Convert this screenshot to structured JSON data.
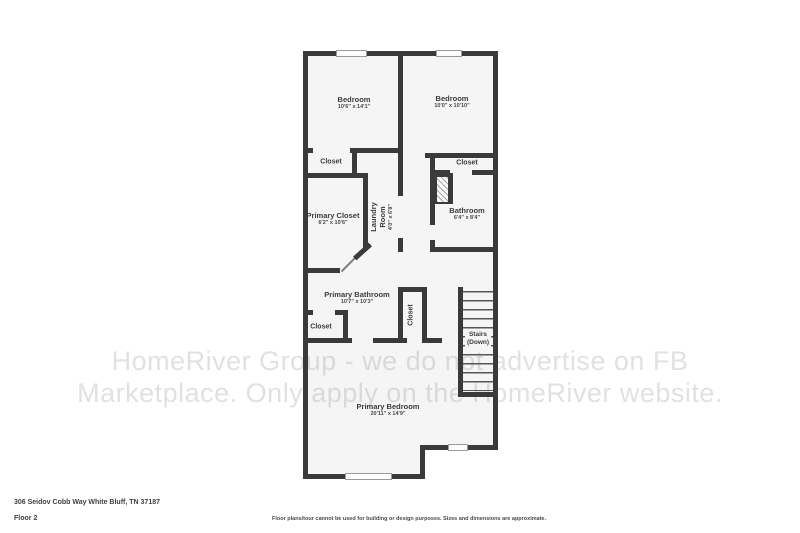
{
  "meta": {
    "address": "306 Seidov Cobb Way White Bluff, TN 37187",
    "floor_label": "Floor 2",
    "disclaimer": "Floor plans/tour cannot be used for building or design purposes. Sizes and dimensions are approximate."
  },
  "watermark": {
    "line1": "HomeRiver Group - we do not advertise on FB",
    "line2": "Marketplace. Only apply on the HomeRiver website."
  },
  "rooms": {
    "bedroom_left": {
      "name": "Bedroom",
      "dims": "10'6\" x 14'1\""
    },
    "bedroom_right": {
      "name": "Bedroom",
      "dims": "10'0\" x 10'10\""
    },
    "closet_left": {
      "name": "Closet"
    },
    "closet_right": {
      "name": "Closet"
    },
    "primary_closet": {
      "name": "Primary Closet",
      "dims": "6'2\" x 10'6\""
    },
    "laundry": {
      "name": "Laundry Room",
      "dims": "4'0\" x 6'8\""
    },
    "bathroom": {
      "name": "Bathroom",
      "dims": "6'4\" x 8'4\""
    },
    "primary_bathroom": {
      "name": "Primary Bathroom",
      "dims": "10'7\" x 10'3\""
    },
    "hall_closet": {
      "name": "Closet"
    },
    "bath_closet": {
      "name": "Closet"
    },
    "stairs": {
      "name": "Stairs",
      "sub": "(Down)"
    },
    "primary_bedroom": {
      "name": "Primary Bedroom",
      "dims": "20'11\" x 14'9\""
    }
  },
  "colors": {
    "wall": "#3a3a3c",
    "floor": "#f5f5f6",
    "watermark_gray": "#dedede"
  }
}
